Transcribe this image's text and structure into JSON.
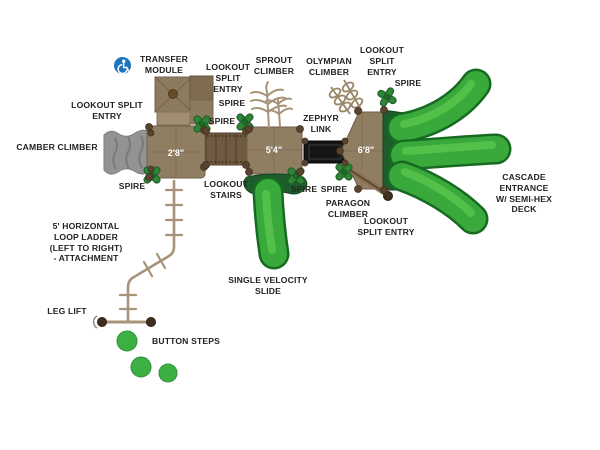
{
  "diagram_title": "playground-equipment-plan-view",
  "decks": {
    "deck_2_8": "2'8\"",
    "deck_5_4": "5'4\"",
    "deck_6_8": "6'8\""
  },
  "labels": {
    "transfer_module": "TRANSFER\nMODULE",
    "lookout_split_entry_top": "LOOKOUT\nSPLIT\nENTRY",
    "sprout_climber": "SPROUT\nCLIMBER",
    "olympian_climber": "OLYMPIAN\nCLIMBER",
    "lookout_split_entry_top_right": "LOOKOUT\nSPLIT\nENTRY",
    "spire_top_right": "SPIRE",
    "lookout_split_entry_left": "LOOKOUT SPLIT\nENTRY",
    "spire_upper_a": "SPIRE",
    "spire_upper_b": "SPIRE",
    "camber_climber": "CAMBER CLIMBER",
    "zephyr_link": "ZEPHYR\nLINK",
    "spire_lower_left": "SPIRE",
    "lookout_stairs": "LOOKOUT\nSTAIRS",
    "spire_lower_a": "SPIRE",
    "spire_lower_b": "SPIRE",
    "paragon_climber": "PARAGON\nCLIMBER",
    "lookout_split_entry_bottom_right": "LOOKOUT\nSPLIT ENTRY",
    "cascade_entrance": "CASCADE ENTRANCE\nW/ SEMI-HEX DECK",
    "single_velocity_slide": "SINGLE VELOCITY\nSLIDE",
    "loop_ladder": "5' HORIZONTAL\nLOOP LADDER\n(LEFT TO RIGHT)\n- ATTACHMENT",
    "leg_lift": "LEG LIFT",
    "button_steps": "BUTTON STEPS"
  },
  "icons": {
    "accessibility": "wheelchair-accessibility"
  },
  "colors": {
    "slide_green": "#38a93a",
    "slide_green_dark": "#176b21",
    "slide_highlight": "#58c44e",
    "entrance_green": "#1f5c2b",
    "spire_green": "#2e8536",
    "deck_tan": "#8f7e62",
    "stair_brown": "#6f5a41",
    "post_brown": "#5a4330",
    "ladder_tan": "#a8937a",
    "camber_gray": "#939393",
    "link_black": "#151515",
    "accent_blue": "#1c75bc",
    "label_color": "#262222"
  }
}
